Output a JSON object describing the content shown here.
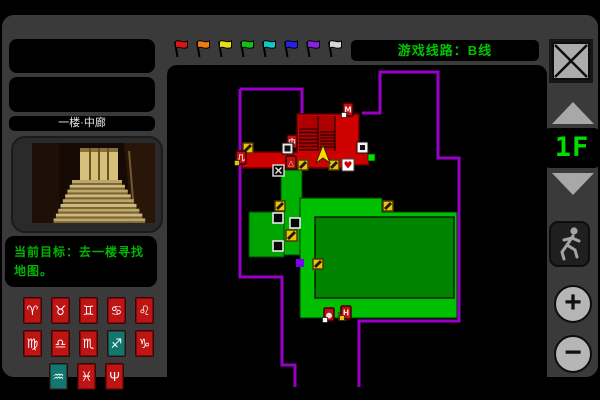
{
  "top_bar": {
    "flags": [
      {
        "name": "flag-red",
        "color": "#D81414"
      },
      {
        "name": "flag-orange",
        "color": "#EE7A10"
      },
      {
        "name": "flag-yellow",
        "color": "#E8E014"
      },
      {
        "name": "flag-green",
        "color": "#12C212"
      },
      {
        "name": "flag-cyan",
        "color": "#10C8C8"
      },
      {
        "name": "flag-blue",
        "color": "#2222E6"
      },
      {
        "name": "flag-purple",
        "color": "#8822E0"
      },
      {
        "name": "flag-white",
        "color": "#D8D8D8"
      }
    ],
    "route_label": "游戏线路：B线",
    "route_color": "#00C400"
  },
  "sidebar": {
    "location_label": "一楼·中廊",
    "goal_text": "当前目标：去一楼寻找地图。",
    "goal_color": "#00B400",
    "zodiac": {
      "red": "#BE1414",
      "teal": "#12776E",
      "rows": [
        [
          {
            "symbol": "♈",
            "variant": "red"
          },
          {
            "symbol": "♉",
            "variant": "red"
          },
          {
            "symbol": "♊",
            "variant": "red"
          },
          {
            "symbol": "♋",
            "variant": "red"
          },
          {
            "symbol": "♌",
            "variant": "red"
          }
        ],
        [
          {
            "symbol": "♍",
            "variant": "red"
          },
          {
            "symbol": "♎",
            "variant": "red"
          },
          {
            "symbol": "♏",
            "variant": "red"
          },
          {
            "symbol": "♐",
            "variant": "teal"
          },
          {
            "symbol": "♑",
            "variant": "red"
          }
        ],
        [
          {
            "symbol": "♒",
            "variant": "teal"
          },
          {
            "symbol": "♓",
            "variant": "red"
          },
          {
            "symbol": "Ψ",
            "variant": "red"
          }
        ]
      ]
    }
  },
  "right_panel": {
    "floor_label": "1F",
    "floor_color": "#00E000",
    "zoom_in_label": "+",
    "zoom_out_label": "−"
  },
  "map": {
    "colors": {
      "outline": "#9800C8",
      "red_room": "#CE0000",
      "red_room_dark": "#AC0000",
      "stairs_line": "#2A0000",
      "green_corridor": "#00B000",
      "green_room_small": "#00A400",
      "green_room_large": "#00BE00",
      "green_room_inner": "#008400",
      "hazard": "#F2C200",
      "player": "#FFD800"
    },
    "player": {
      "x": 321,
      "y": 140
    },
    "markers": [
      {
        "type": "hazard",
        "x": 241,
        "y": 128,
        "s": 10
      },
      {
        "type": "hazard",
        "x": 296,
        "y": 145,
        "s": 10
      },
      {
        "type": "hazard",
        "x": 327,
        "y": 145,
        "s": 10
      },
      {
        "type": "hazard",
        "x": 273,
        "y": 186,
        "s": 10
      },
      {
        "type": "hazard",
        "x": 284,
        "y": 215,
        "s": 11
      },
      {
        "type": "hazard",
        "x": 311,
        "y": 244,
        "s": 10
      },
      {
        "type": "hazard",
        "x": 381,
        "y": 186,
        "s": 10
      },
      {
        "type": "hazard",
        "x": 337,
        "y": 298,
        "s": 7
      },
      {
        "type": "black_door",
        "x": 271,
        "y": 198,
        "s": 10
      },
      {
        "type": "black_door",
        "x": 288,
        "y": 203,
        "s": 10
      },
      {
        "type": "black_door",
        "x": 271,
        "y": 226,
        "s": 10
      },
      {
        "type": "xbox",
        "x": 271,
        "y": 150,
        "s": 11
      },
      {
        "type": "white_door",
        "x": 355,
        "y": 127,
        "s": 11
      },
      {
        "type": "badge",
        "x": 285,
        "y": 120,
        "glyph": "中",
        "chip": null
      },
      {
        "type": "info_white",
        "x": 280,
        "y": 128,
        "s": 11
      },
      {
        "type": "heart",
        "x": 340,
        "y": 144,
        "s": 12
      },
      {
        "type": "door_green",
        "x": 366,
        "y": 139,
        "s": 7
      },
      {
        "type": "door_purple",
        "x": 294,
        "y": 244,
        "s": 8
      },
      {
        "type": "badge",
        "x": 234,
        "y": 136,
        "glyph": "几",
        "chip": "#E8C000"
      },
      {
        "type": "badge",
        "x": 284,
        "y": 141,
        "glyph": "△",
        "chip": null
      },
      {
        "type": "badge",
        "x": 341,
        "y": 88,
        "glyph": "M",
        "chip": "#FFFFFF"
      },
      {
        "type": "badge",
        "x": 322,
        "y": 293,
        "glyph": "●",
        "chip": "#FFFFFF"
      },
      {
        "type": "badge",
        "x": 339,
        "y": 291,
        "glyph": "H",
        "chip": "#E8C000"
      }
    ]
  }
}
